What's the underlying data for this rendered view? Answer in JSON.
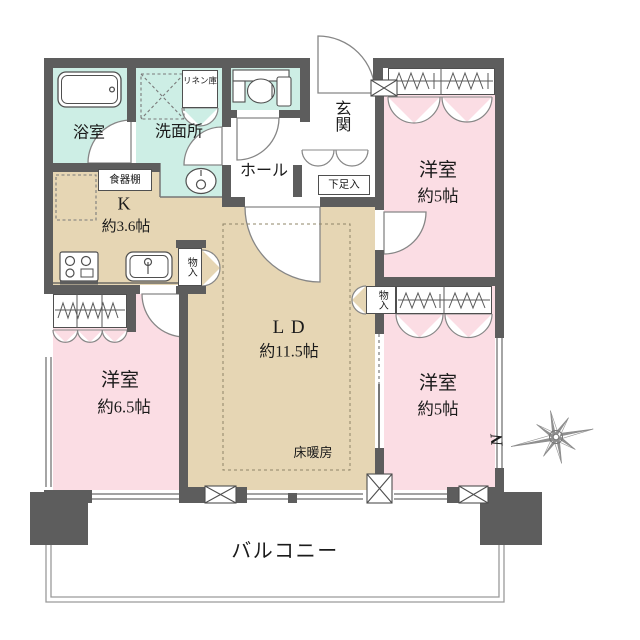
{
  "plan": {
    "bath": "浴室",
    "washroom": "洗面所",
    "linen_closet": "リネン庫",
    "cupboard": "食器棚",
    "kitchen": {
      "label": "K",
      "size": "約3.6帖"
    },
    "hall": "ホール",
    "entrance": "玄関",
    "shoe_cabinet": "下足入",
    "living_dining": {
      "label": "LD",
      "size": "約11.5帖"
    },
    "floor_heating": "床暖房",
    "bedroom_top_right": {
      "label": "洋室",
      "size": "約5帖"
    },
    "bedroom_bottom_right": {
      "label": "洋室",
      "size": "約5帖"
    },
    "bedroom_bottom_left": {
      "label": "洋室",
      "size": "約6.5帖"
    },
    "storage_kitchen": "物入",
    "storage_right": "物入",
    "balcony": "バルコニー",
    "compass_north": "N"
  },
  "colors": {
    "wall": "#5d5d5d",
    "water_rooms": "#cdeee5",
    "kitchen_ld": "#e6d6b4",
    "bedrooms": "#fbdde4",
    "line": "#777777"
  }
}
